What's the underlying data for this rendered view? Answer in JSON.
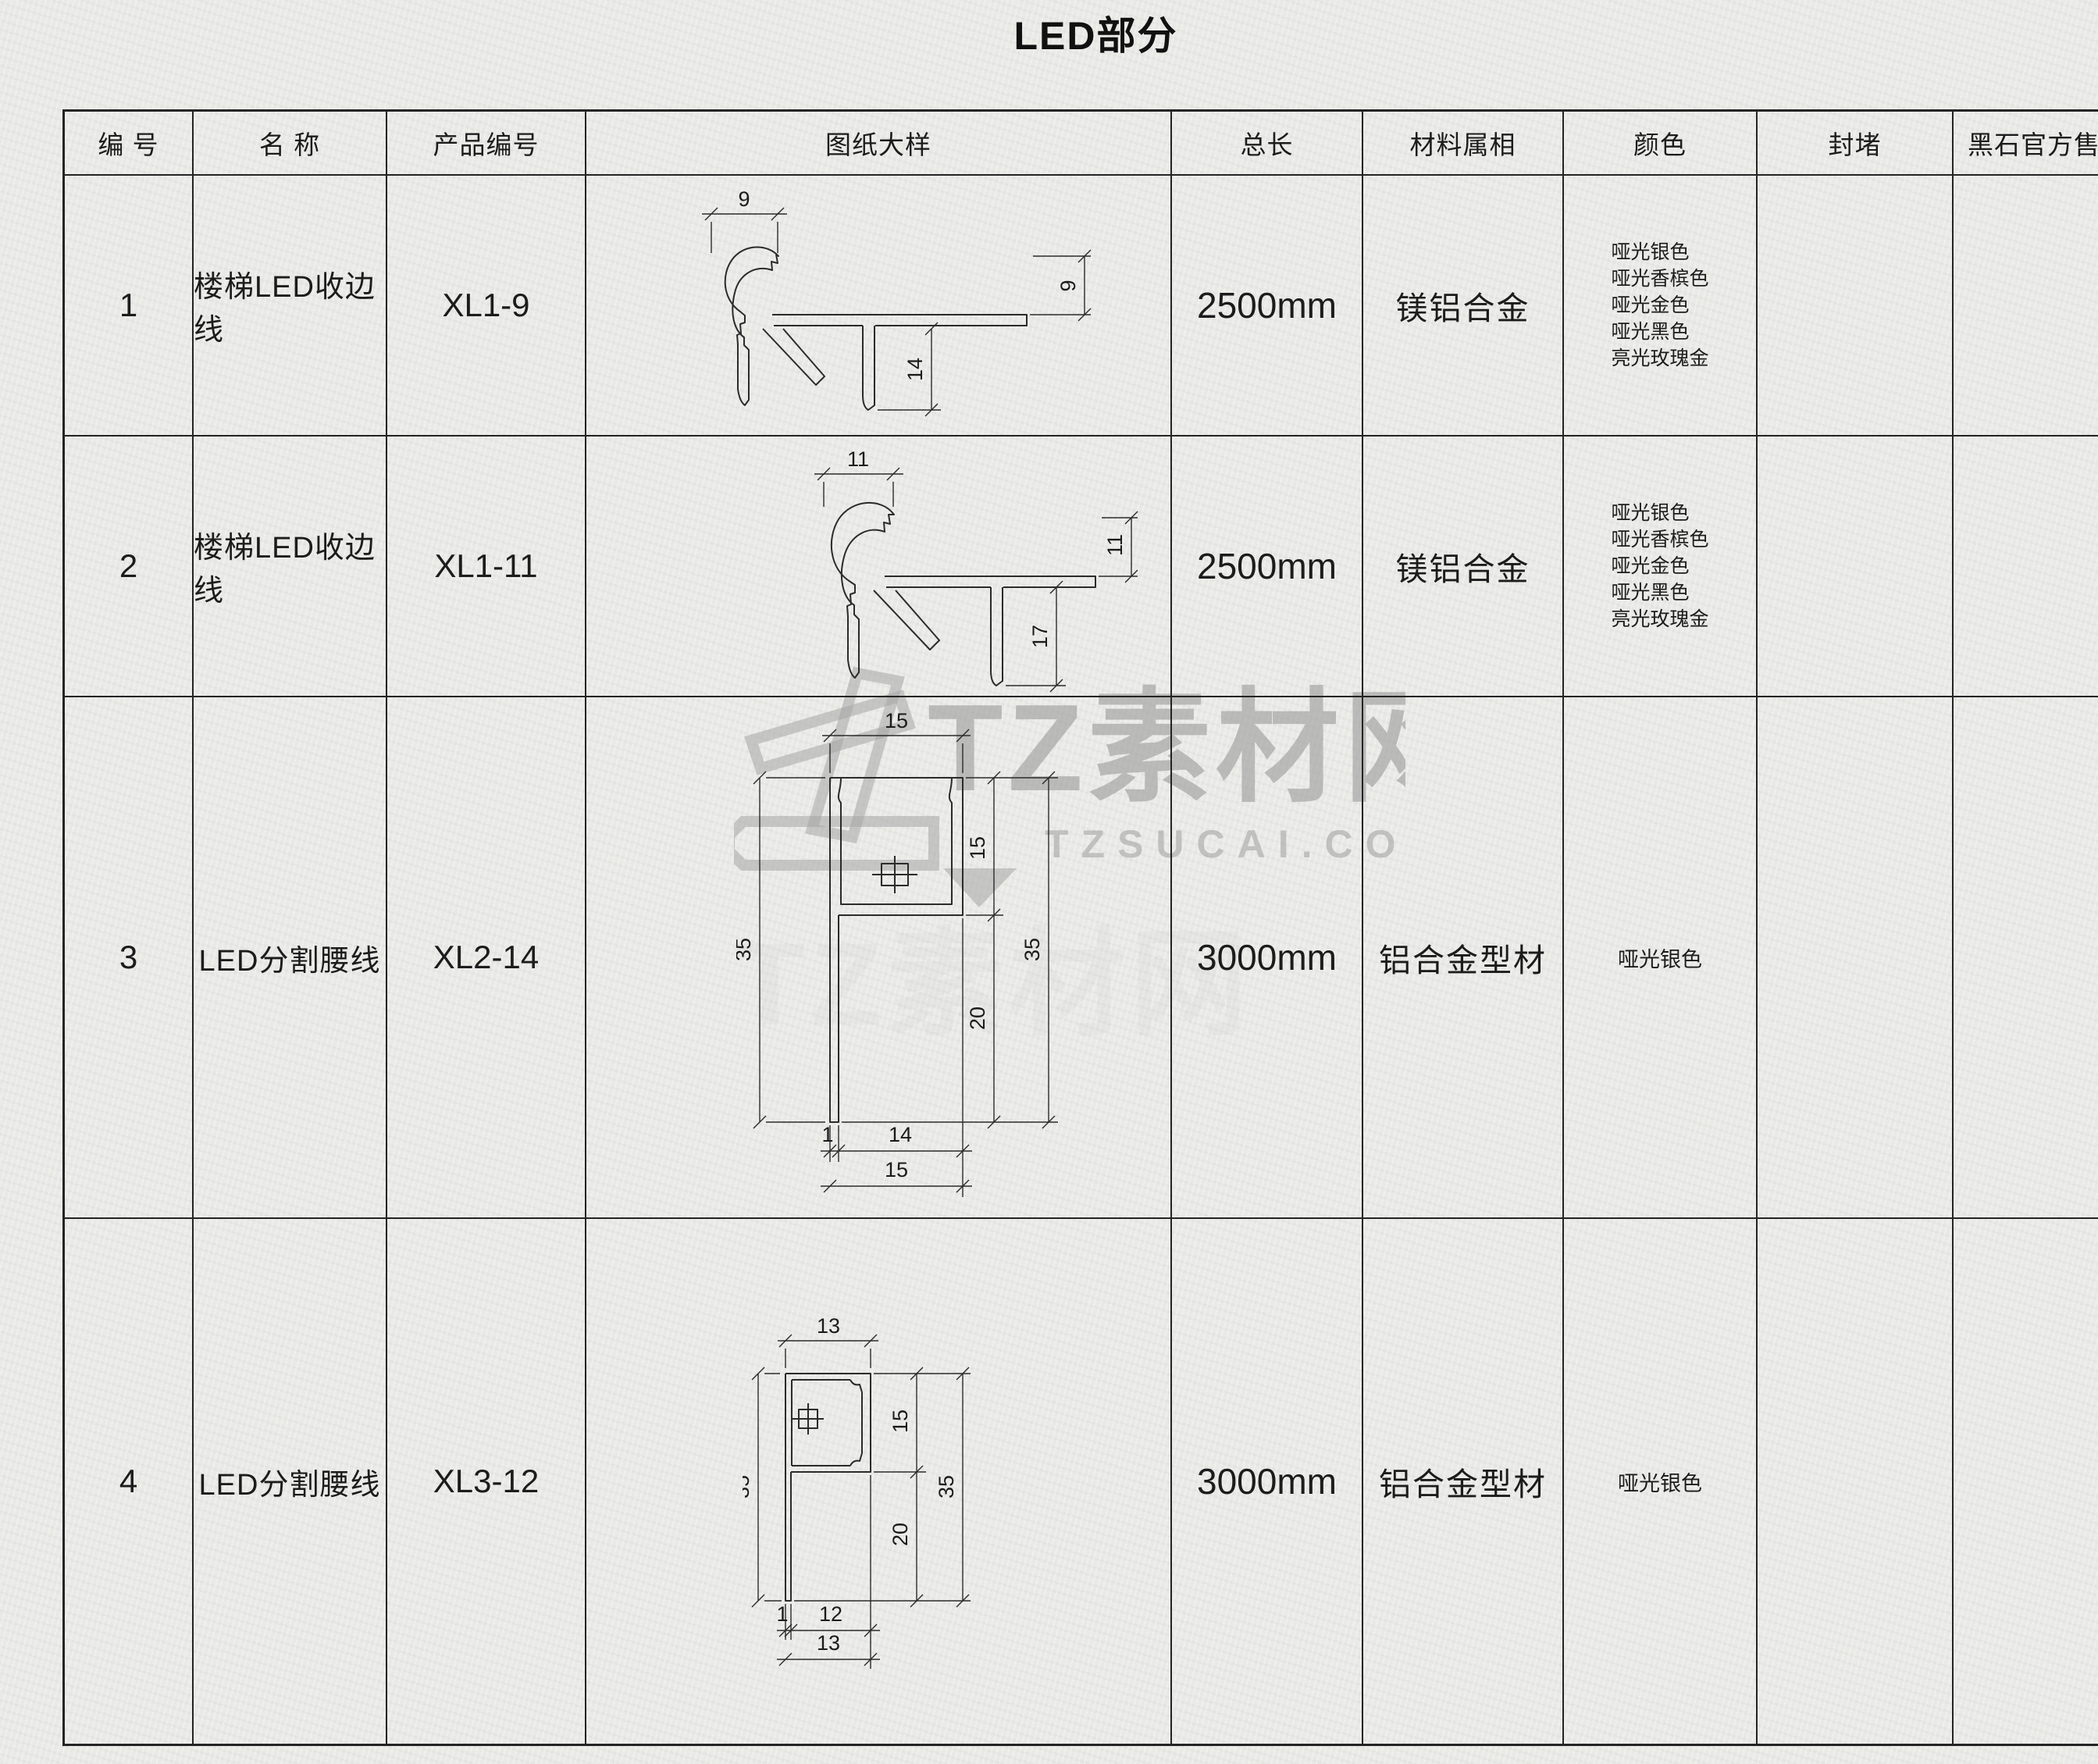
{
  "title": "LED部分",
  "table": {
    "headers": {
      "no": "编  号",
      "name": "名  称",
      "code": "产品编号",
      "drawing": "图纸大样",
      "length": "总长",
      "material": "材料属相",
      "color": "颜色",
      "seal": "封堵",
      "price": "黑石官方售价"
    },
    "rows": [
      {
        "no": "1",
        "name": "楼梯LED收边线",
        "code": "XL1-9",
        "length": "2500mm",
        "material": "镁铝合金",
        "colors": "哑光银色\n哑光香槟色\n哑光金色\n哑光黑色\n亮光玫瑰金",
        "seal": "",
        "price": ""
      },
      {
        "no": "2",
        "name": "楼梯LED收边线",
        "code": "XL1-11",
        "length": "2500mm",
        "material": "镁铝合金",
        "colors": "哑光银色\n哑光香槟色\n哑光金色\n哑光黑色\n亮光玫瑰金",
        "seal": "",
        "price": ""
      },
      {
        "no": "3",
        "name": "LED分割腰线",
        "code": "XL2-14",
        "length": "3000mm",
        "material": "铝合金型材",
        "colors": "哑光银色",
        "seal": "",
        "price": ""
      },
      {
        "no": "4",
        "name": "LED分割腰线",
        "code": "XL3-12",
        "length": "3000mm",
        "material": "铝合金型材",
        "colors": "哑光银色",
        "seal": "",
        "price": ""
      }
    ]
  },
  "drawings": {
    "xl1_9": {
      "top": "9",
      "right": "9",
      "stem": "14"
    },
    "xl1_11": {
      "top": "11",
      "right": "11",
      "stem": "17"
    },
    "xl2_14": {
      "top": "15",
      "right_upper": "15",
      "left": "35",
      "right_outer": "35",
      "right_lower": "20",
      "bottom_leg": "1",
      "bottom_inner": "14",
      "bottom_total": "15"
    },
    "xl3_12": {
      "top": "13",
      "right_upper": "15",
      "left": "35",
      "right_outer": "35",
      "right_lower": "20",
      "bottom_leg": "1",
      "bottom_inner": "12",
      "bottom_total": "13"
    }
  },
  "watermark": {
    "brand": "TZ素材网",
    "domain": "TZSUCAI.COM"
  },
  "palette": {
    "paper": "#e9e9e6",
    "line": "#242424",
    "text": "#1c1c1c",
    "watermark_gray": "#a3a3a3"
  }
}
